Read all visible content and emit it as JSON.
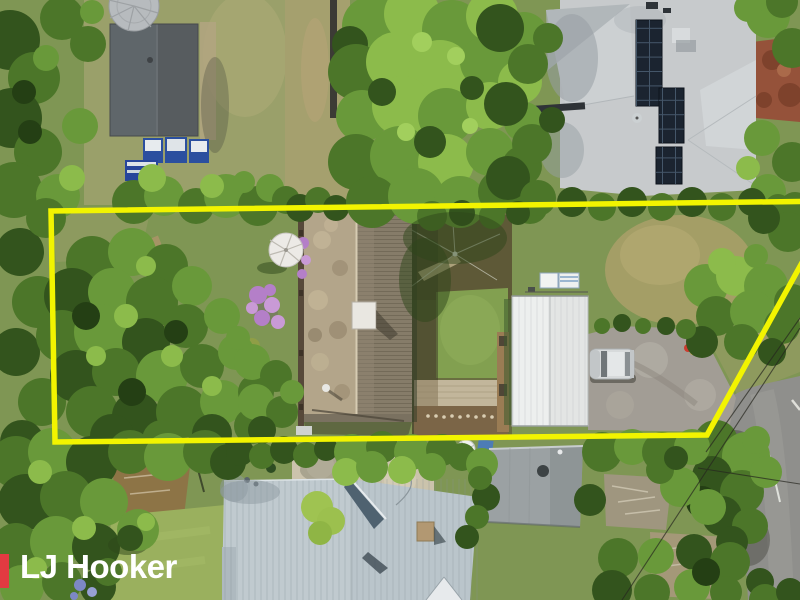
{
  "watermark": {
    "brand": "LJ Hooker"
  },
  "colors": {
    "boundary_yellow": "#F2F400",
    "brand_red": "#E23A41",
    "brand_white": "#FFFFFF"
  }
}
